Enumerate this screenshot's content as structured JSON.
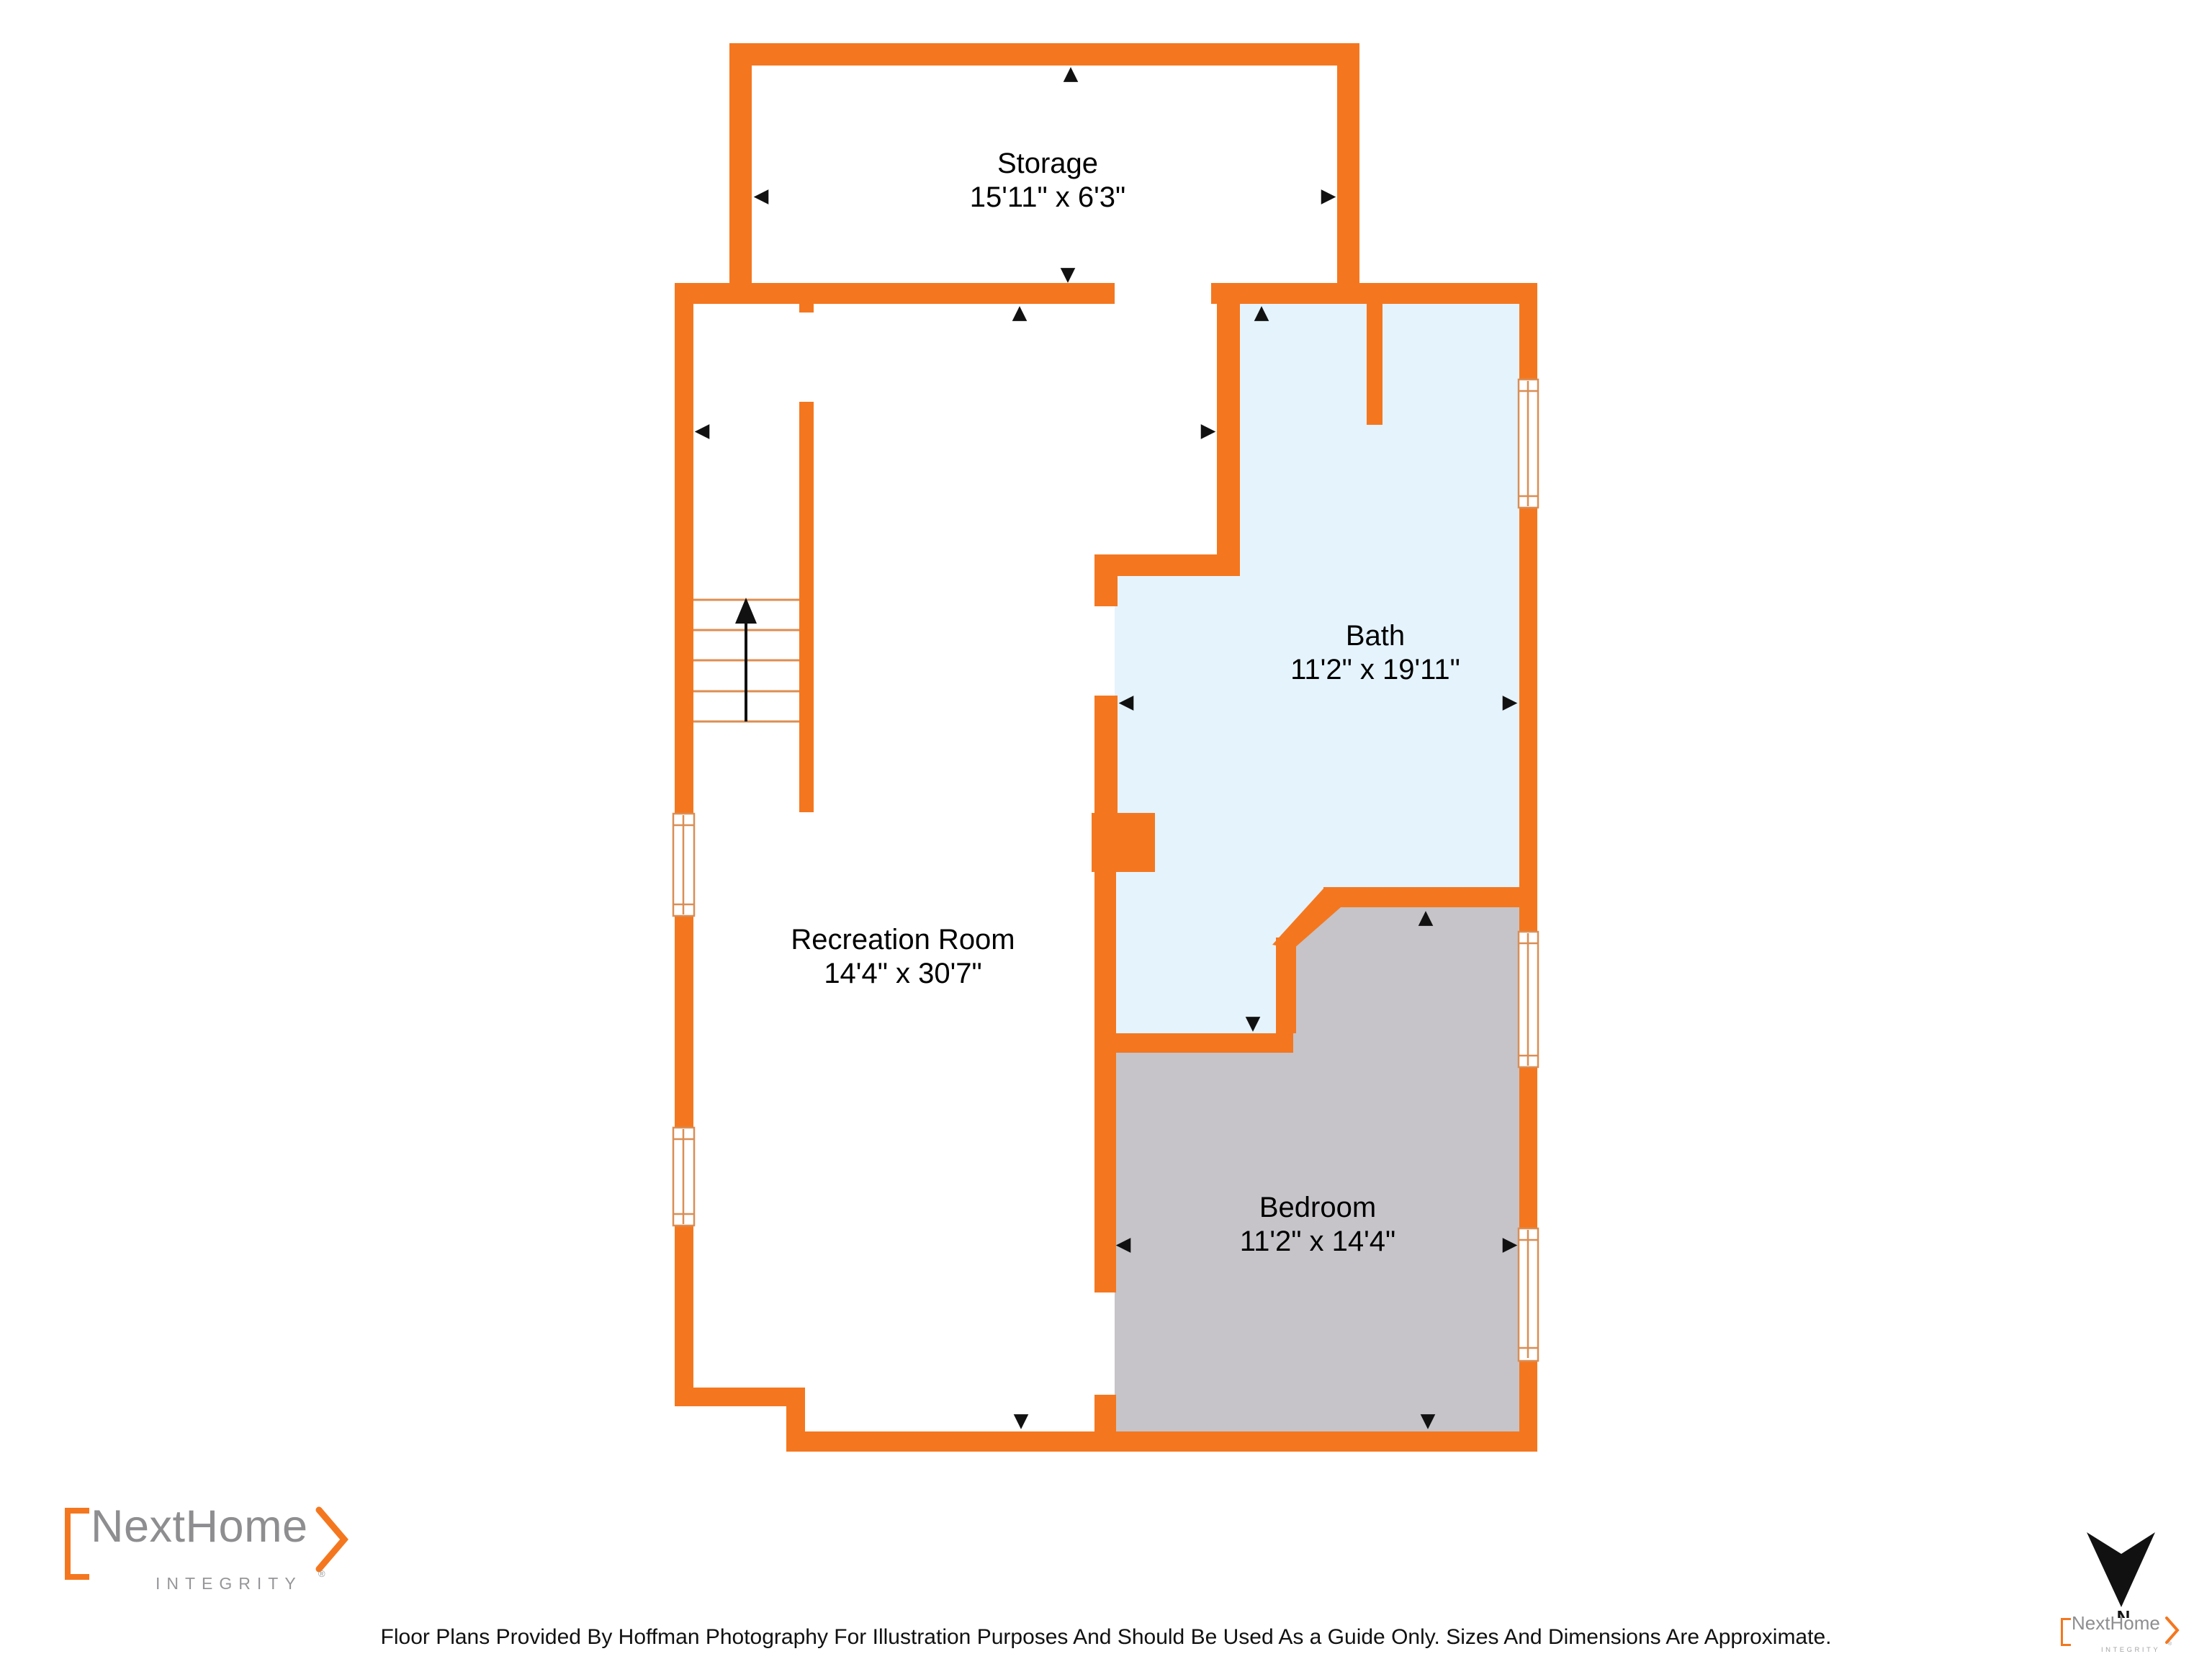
{
  "rooms": [
    {
      "id": "storage",
      "name": "Storage",
      "dims": "15'11\" x 6'3\""
    },
    {
      "id": "bath",
      "name": "Bath",
      "dims": "11'2\" x 19'11\""
    },
    {
      "id": "recreation",
      "name": "Recreation Room",
      "dims": "14'4\" x 30'7\""
    },
    {
      "id": "bedroom",
      "name": "Bedroom",
      "dims": "11'2\" x 14'4\""
    }
  ],
  "branding": {
    "big": {
      "name": "NextHome",
      "tagline": "INTEGRITY",
      "registered": "®"
    },
    "small": {
      "name": "NextHome",
      "tagline": "INTEGRITY",
      "registered": "®"
    }
  },
  "footer": {
    "disclaimer": "Floor Plans Provided By Hoffman Photography For Illustration Purposes And Should Be Used As a Guide Only. Sizes And Dimensions Are Approximate."
  },
  "compass": {
    "letter": "N"
  },
  "icons": {
    "tri_up": "▲",
    "tri_down": "▼",
    "tri_left": "◀",
    "tri_right": "▶"
  },
  "colors": {
    "wall_orange": "#F4771F",
    "window_frame": "#D98E55",
    "stair_line": "#DD8E52",
    "bath_fill": "#E5F3FC",
    "bedroom_fill": "#C6C4C8",
    "label_text": "#2B2B2B",
    "logo_gray": "#8E8E91"
  }
}
